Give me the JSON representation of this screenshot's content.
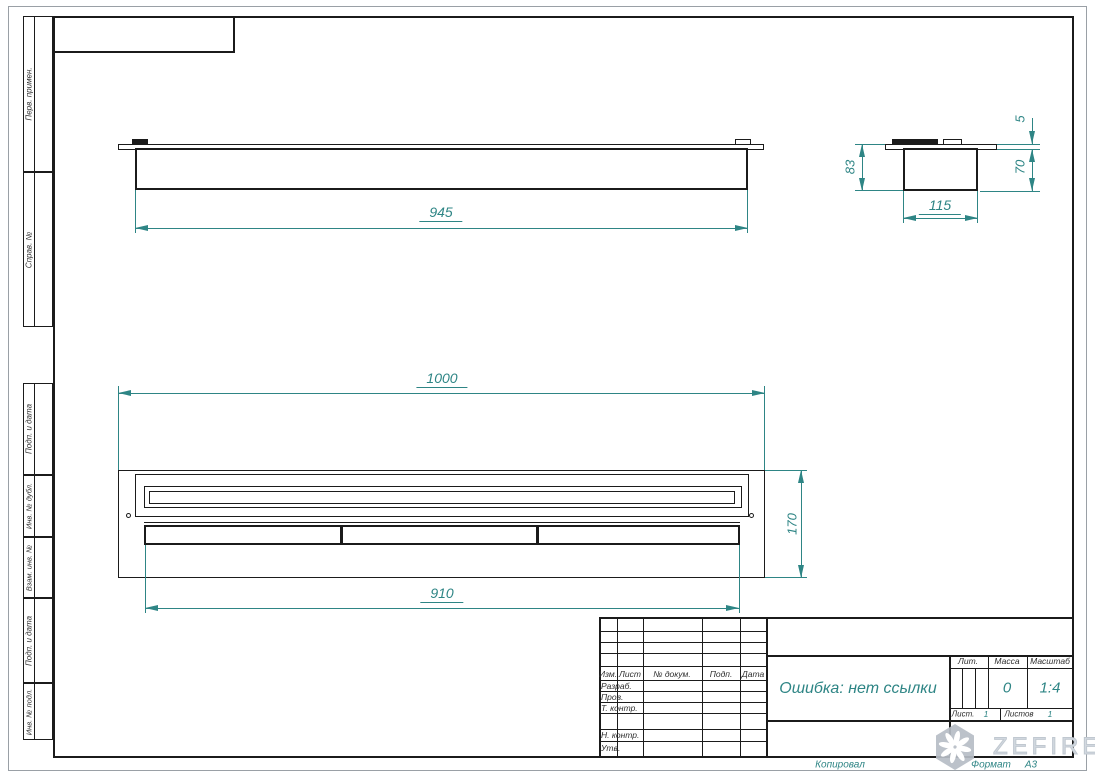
{
  "margin_labels": [
    "Перв. примен.",
    "Справ. №",
    "Подп. и дата",
    "Инв. № дубл.",
    "Взам. инв. №",
    "Подп. и дата",
    "Инв. № подл."
  ],
  "dimensions": {
    "front_width": "945",
    "side_height": "83",
    "side_width": "115",
    "side_flange": "5",
    "side_body_height": "70",
    "plan_width": "1000",
    "plan_depth": "170",
    "plan_lid_width": "910"
  },
  "title_block": {
    "change_cols": [
      "Изм.",
      "Лист",
      "№ докум.",
      "Подп.",
      "Дата"
    ],
    "sign_rows": [
      "Разраб.",
      "Пров.",
      "Т. контр.",
      "Н. контр.",
      "Утв."
    ],
    "doc_name": "Ошибка: нет ссылки",
    "lit_label": "Лит.",
    "mass_label": "Масса",
    "mass_value": "0",
    "scale_label": "Масштаб",
    "scale_value": "1:4",
    "sheet_label": "Лист.",
    "sheet_value": "1",
    "sheets_label": "Листов",
    "sheets_value": "1",
    "copied_label": "Копировал",
    "format_label": "Формат",
    "format_value": "А3"
  },
  "watermark": {
    "text": "ZEFIRE"
  },
  "colors": {
    "dimension": "#2e8585",
    "line": "#1b1b1b",
    "watermark": "#c7ced6"
  }
}
